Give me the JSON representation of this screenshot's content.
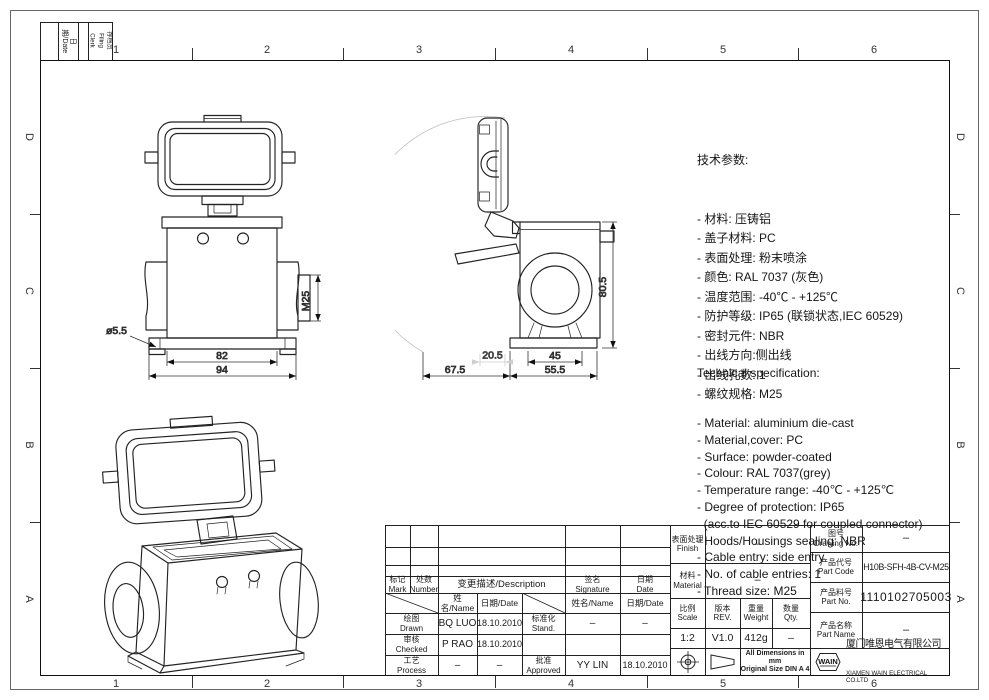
{
  "frame": {
    "zones_h": [
      "1",
      "2",
      "3",
      "4",
      "5",
      "6"
    ],
    "zones_v": [
      "D",
      "C",
      "B",
      "A"
    ],
    "corner_date": "日期/Date",
    "corner_clerk": "存档员\nFiling Clerk"
  },
  "specs_cn": {
    "title": "技术参数:",
    "lines": [
      "- 材料: 压铸铝",
      "- 盖子材料: PC",
      "- 表面处理: 粉末喷涂",
      "- 颜色: RAL 7037 (灰色)",
      "- 温度范围: -40℃ - +125℃",
      "- 防护等级: IP65 (联锁状态,IEC 60529)",
      "- 密封元件: NBR",
      "- 出线方向:侧出线",
      "- 出线孔数: 1",
      "- 螺纹规格: M25"
    ]
  },
  "specs_en": {
    "title": "Technical specification:",
    "lines": [
      "- Material: aluminium die-cast",
      "- Material,cover: PC",
      "- Surface: powder-coated",
      "- Colour: RAL 7037(grey)",
      "- Temperature range: -40℃ - +125℃",
      "- Degree of protection: IP65",
      "  (acc.to IEC 60529 for coupled connector)",
      "- Hoods/Housings sealing: NBR",
      "- Cable entry: side entry",
      "- No. of cable entries: 1",
      "- Thread size: M25"
    ]
  },
  "views": {
    "front": {
      "d82": "82",
      "d94": "94",
      "hole": "ø5.5",
      "thread": "M25"
    },
    "side": {
      "h": "80.5",
      "w45": "45",
      "w555": "55.5",
      "w675": "67.5",
      "w205": "20.5"
    }
  },
  "tb": {
    "mark": "标记\nMark",
    "number": "处数\nNumber",
    "desc": "变更描述/Description",
    "sig": "签名\nSignature",
    "date": "日期\nDate",
    "name_date": "姓名/Name",
    "date2": "日期/Date",
    "drawn": "绘图\nDrawn",
    "drawn_name": "BQ LUO",
    "drawn_date": "18.10.2010",
    "stand": "标准化\nStand.",
    "stand_sig": "–",
    "stand_date": "–",
    "checked": "审核\nChecked",
    "checked_name": "P RAO",
    "checked_date": "18.10.2010",
    "process": "工艺\nProcess",
    "process_name": "–",
    "process_date": "–",
    "approved": "批准\nApproved",
    "approved_sig": "YY LIN",
    "approved_date": "18.10.2010",
    "finish": "表面处理\nFinish",
    "finish_val": "–",
    "material": "材料\nMaterial",
    "material_val": "–",
    "scale": "比例\nScale",
    "scale_val": "1:2",
    "rev": "版本\nREV.",
    "rev_val": "V1.0",
    "weight": "重量\nWeight",
    "weight_val": "412g",
    "qty": "数量\nQty.",
    "qty_val": "–",
    "note": "All Dimensions in mm\nOriginal Size DIN A 4",
    "drawing_no": "图号\nDrawing No.",
    "drawing_no_val": "–",
    "part_code": "产品代号\nPart Code",
    "part_code_val": "H10B-SFH-4B-CV-M25",
    "part_no": "产品料号\nPart No.",
    "part_no_val": "1110102705003",
    "part_name": "产品名称\nPart Name",
    "part_name_val": "–",
    "logo": "WAIN",
    "company_cn": "厦门唯恩电气有限公司",
    "company_en": "XIAMEN WAIN ELECTRICAL CO.LTD"
  }
}
